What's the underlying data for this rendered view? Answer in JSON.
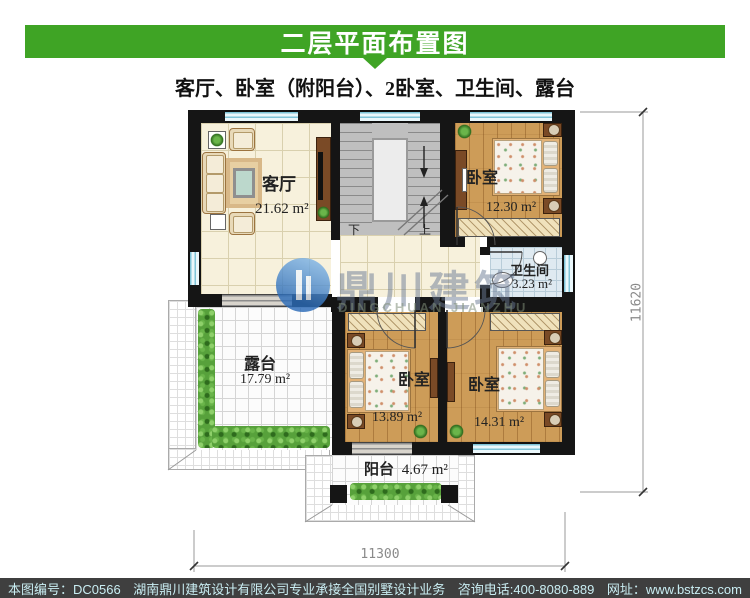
{
  "header": {
    "title": "二层平面布置图",
    "subtitle": "客厅、卧室（附阳台）、2卧室、卫生间、露台"
  },
  "rooms": {
    "living": {
      "label": "客厅",
      "area": "21.62 m²"
    },
    "bedroom_top": {
      "label": "卧室",
      "area": "12.30 m²"
    },
    "bathroom": {
      "label": "卫生间",
      "area": "3.23 m²"
    },
    "bedroom_left": {
      "label": "卧室",
      "area": "13.89 m²"
    },
    "bedroom_right": {
      "label": "卧室",
      "area": "14.31 m²"
    },
    "terrace": {
      "label": "露台",
      "area": "17.79 m²"
    },
    "balcony": {
      "label": "阳台",
      "area": "4.67 m²"
    }
  },
  "stairs": {
    "down": "下",
    "up": "上"
  },
  "dimensions": {
    "bottom": "11300",
    "right": "11620"
  },
  "watermark": {
    "name": "鼎川建筑",
    "name_en": "DINGCHUAN JIANZHU"
  },
  "footer": {
    "drawing_no": "本图编号：DC0566",
    "company": "湖南鼎川建筑设计有限公司专业承接全国别墅设计业务",
    "phone": "咨询电话:400-8080-889",
    "website": "网址：www.bstzcs.com"
  },
  "colors": {
    "header_green": "#3fa425",
    "footer_bg": "#3f3f3f",
    "footer_text": "#c9edf2",
    "wall_black": "#151515",
    "window_cyan": "#7fc4d8",
    "wood_floor": "#cd9c58"
  }
}
